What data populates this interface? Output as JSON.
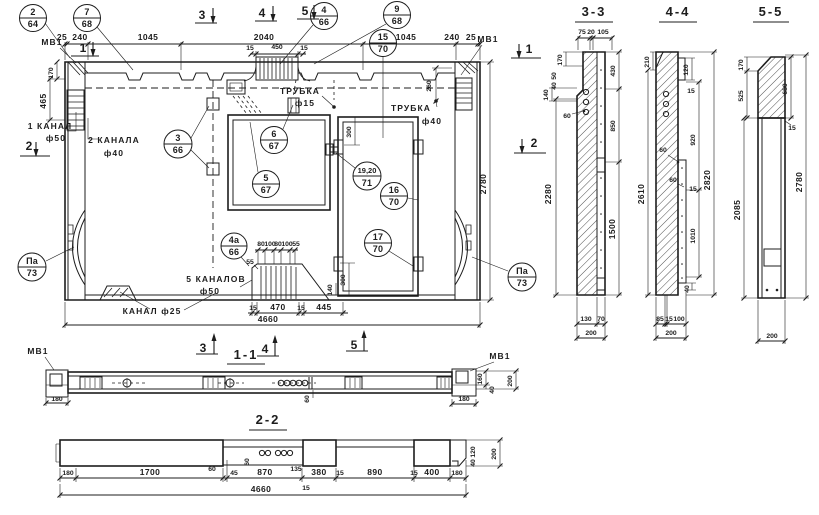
{
  "page": {
    "paper": "#ffffff",
    "ink": "#1d1d1d"
  },
  "callouts": [
    {
      "num": "2",
      "den": "64"
    },
    {
      "num": "7",
      "den": "68"
    },
    {
      "num": "4",
      "den": "66"
    },
    {
      "num": "9",
      "den": "68"
    },
    {
      "num": "3",
      "den": "66"
    },
    {
      "num": "6",
      "den": "67"
    },
    {
      "num": "5",
      "den": "67"
    },
    {
      "num": "15",
      "den": "70"
    },
    {
      "num": "19,20",
      "den": "71"
    },
    {
      "num": "16",
      "den": "70"
    },
    {
      "num": "17",
      "den": "70"
    },
    {
      "num": "4а",
      "den": "66"
    },
    {
      "num": "Па",
      "den": "73"
    },
    {
      "num": "Па",
      "den": "73"
    }
  ],
  "markers": {
    "top": [
      "3",
      "4",
      "5"
    ],
    "left": [
      "1",
      "2"
    ],
    "right": [
      "1",
      "2"
    ],
    "bottom": [
      "3",
      "4",
      "5"
    ]
  },
  "view_titles": {
    "v11": "1-1",
    "v22": "2-2",
    "s33": "3-3",
    "s44": "4-4",
    "s55": "5-5"
  },
  "labels": {
    "mv1": "МВ1",
    "kanal1_line1": "1 КАНАЛ",
    "kanal1_line2": "ф50",
    "kanal2_line1": "2 КАНАЛА",
    "kanal2_line2": "ф40",
    "kanal25": "КАНАЛ ф25",
    "kanal5_line1": "5 КАНАЛОВ",
    "kanal5_line2": "ф50",
    "trubka": "ТРУБКА",
    "dia15": "ф15",
    "dia40": "ф40"
  },
  "dims": {
    "main_top": [
      "25",
      "240",
      "1045",
      "2040",
      "1045",
      "240",
      "25"
    ],
    "main_top2": [
      "15",
      "450",
      "15"
    ],
    "main_left": [
      "170",
      "465"
    ],
    "main_right": [
      "260",
      "2780"
    ],
    "main_inner": [
      "300",
      "300",
      "140"
    ],
    "main_bottom": [
      "15",
      "470",
      "15",
      "445"
    ],
    "channels": [
      "80",
      "100",
      "80",
      "100",
      "55"
    ],
    "channels_side": "55",
    "main_total": "4660",
    "v11": {
      "left": "180",
      "right": "180",
      "h160": "160",
      "h40": "40",
      "h200": "200",
      "mid60": "60"
    },
    "v22": {
      "row": [
        "180",
        "1700",
        "60",
        "45",
        "870",
        "135",
        "15",
        "380",
        "15",
        "890",
        "15",
        "400",
        "180"
      ],
      "rot60": "60",
      "rot120": "120",
      "rot40": "40",
      "rot200": "200",
      "total": "4660"
    },
    "s33": {
      "top": [
        "75",
        "20",
        "105"
      ],
      "left": [
        "170",
        "50",
        "40",
        "140",
        "60",
        "2280"
      ],
      "right": [
        "430",
        "850",
        "1500"
      ],
      "bottom": [
        "130",
        "70",
        "200"
      ]
    },
    "s44": {
      "left": [
        "210",
        "2610"
      ],
      "right": [
        "120",
        "15",
        "60",
        "60",
        "15",
        "920",
        "1010",
        "40",
        "2820"
      ],
      "bottom": [
        "85",
        "15",
        "100",
        "200"
      ]
    },
    "s55": {
      "left": [
        "170",
        "525",
        "2085"
      ],
      "right": [
        "680",
        "15",
        "2780"
      ],
      "bottom": "200"
    }
  }
}
